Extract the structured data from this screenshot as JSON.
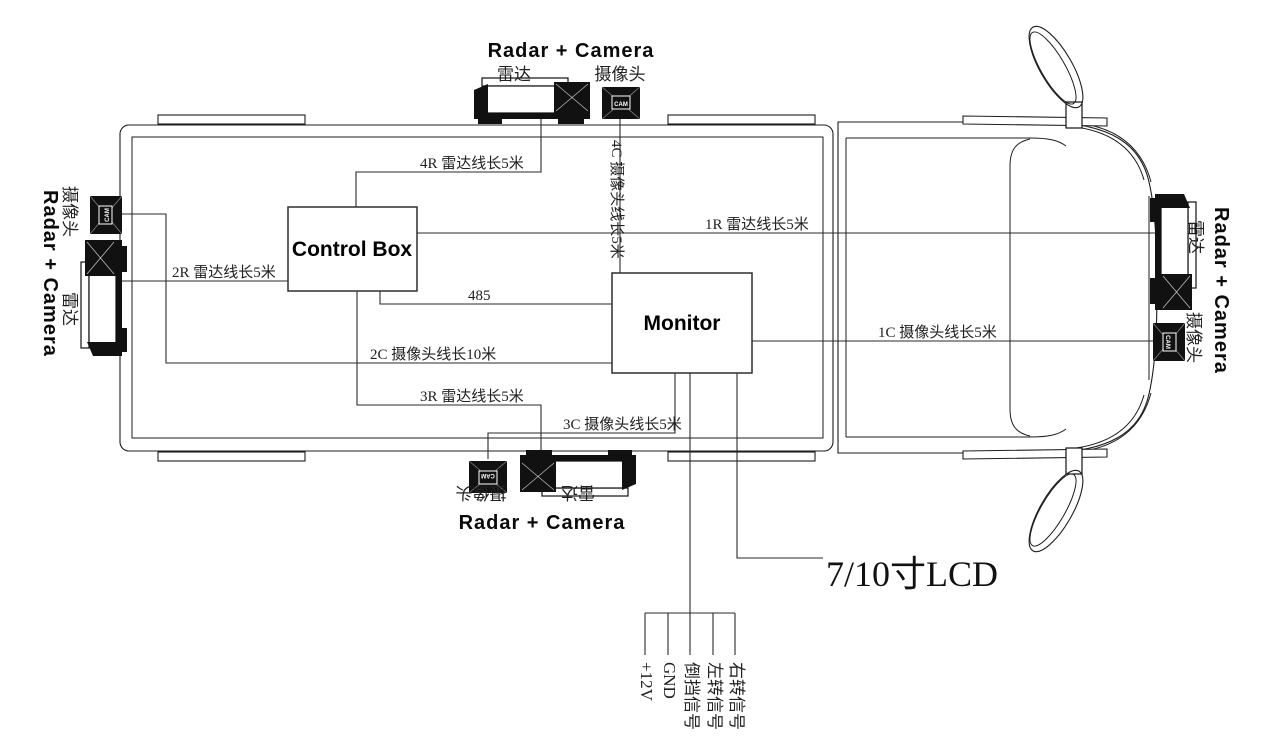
{
  "colors": {
    "line": "#1d1d1d",
    "device_fill": "#111111",
    "text": "#222222"
  },
  "boxes": {
    "control_box": "Control Box",
    "monitor": "Monitor"
  },
  "device_group": {
    "title": "Radar + Camera",
    "radar_cn": "雷达",
    "camera_cn": "摄像头",
    "cam_tag": "CAM"
  },
  "wire_labels": {
    "w4R": "4R 雷达线长5米",
    "w1R": "1R 雷达线长5米",
    "w2R": "2R 雷达线长5米",
    "w3R": "3R 雷达线长5米",
    "w485": "485",
    "w2C": "2C 摄像头线长10米",
    "w3C": "3C 摄像头线长5米",
    "w1C": "1C 摄像头线长5米",
    "w4C": "4C 摄像头线长5米"
  },
  "lcd_label": "7/10寸LCD",
  "signals": [
    "+12V",
    "GND",
    "倒挡信号",
    "左转信号",
    "右转信号"
  ]
}
